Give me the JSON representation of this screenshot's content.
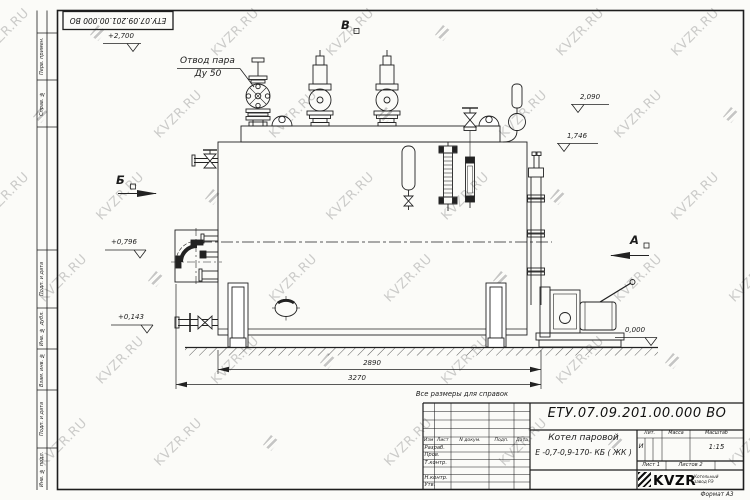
{
  "watermark": {
    "text": "KVZR.RU"
  },
  "stamp": {
    "number": "ЕТУ.07.09.201.00.000  ВО"
  },
  "margin_labels": [
    "Перв. примен.",
    "Справ. №",
    "Подп. и дата",
    "Инв. № дубл.",
    "Взам. инв. №",
    "Подп. и дата",
    "Инв. № подл."
  ],
  "views": {
    "top": "В",
    "left": "Б",
    "right": "А"
  },
  "callout": {
    "line1": "Отвод пара",
    "line2": "Ду 50"
  },
  "elevations": {
    "top": "+2,700",
    "r1": "2,090",
    "r2": "1,746",
    "l1": "+0,796",
    "l2": "+0,143",
    "zero": "0,000"
  },
  "dims": {
    "d1": "2890",
    "d2": "3270"
  },
  "note": "Все размеры для справок",
  "title_block": {
    "doc_number": "ЕТУ.07.09.201.00.000  ВО",
    "product_name": "Котел паровой",
    "product_code": "Е -0,7-0,9-170- КБ ( ЖК )",
    "cols": [
      "Изм",
      "Лист",
      "N докум.",
      "Подп.",
      "Дата"
    ],
    "sign_rows": [
      "Разраб.",
      "Пров.",
      "Т.контр.",
      "Н.контр.",
      "Утв."
    ],
    "lit_label": "Лит.",
    "mass_label": "Масса",
    "scale_label": "Масштаб",
    "lit_value": "И",
    "scale_value": "1:15",
    "sheet": "Лист 1",
    "sheets": "Листов 2",
    "logo": "KVZR",
    "logo_sub1": "Котельный",
    "logo_sub2": "завод РЭ",
    "format": "Формат А3"
  }
}
